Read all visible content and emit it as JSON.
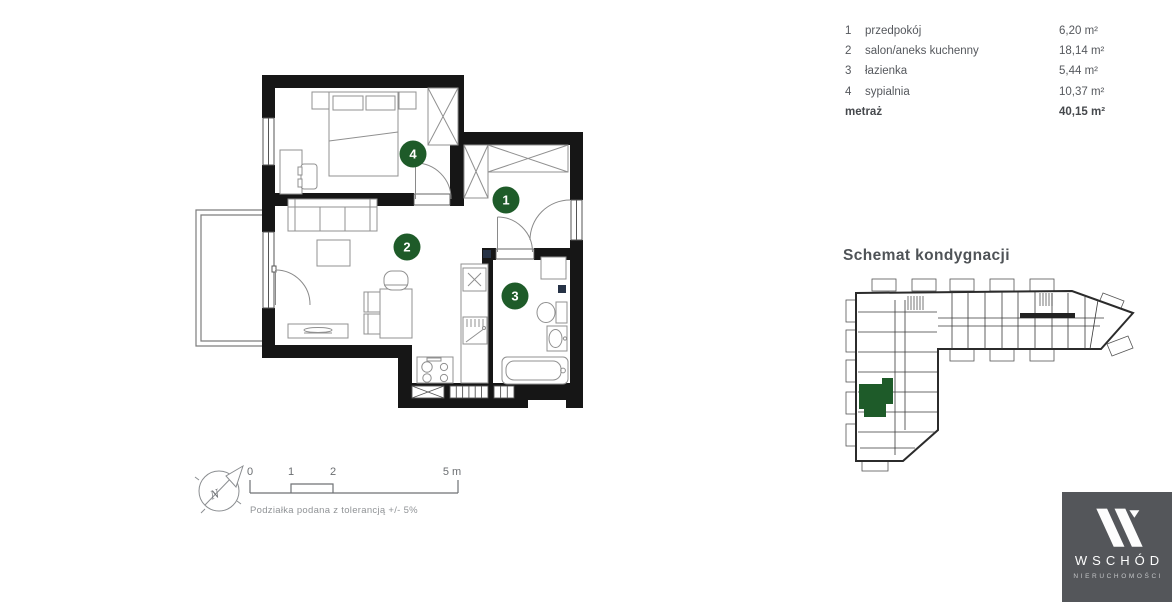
{
  "colors": {
    "brand_green": "#1e5b29",
    "wall_black": "#161616",
    "logo_bg": "#54565a"
  },
  "legend": {
    "rows": [
      {
        "num": "1",
        "label": "przedpokój",
        "area": "6,20 m²"
      },
      {
        "num": "2",
        "label": "salon/aneks kuchenny",
        "area": "18,14 m²"
      },
      {
        "num": "3",
        "label": "łazienka",
        "area": "5,44 m²"
      },
      {
        "num": "4",
        "label": "sypialnia",
        "area": "10,37 m²"
      }
    ],
    "total_label": "metraż",
    "total_area": "40,15 m²"
  },
  "plan": {
    "room_markers": [
      {
        "num": "1"
      },
      {
        "num": "2"
      },
      {
        "num": "3"
      },
      {
        "num": "4"
      }
    ]
  },
  "schematic": {
    "title": "Schemat kondygnacji"
  },
  "scalebar": {
    "tick0": "0",
    "tick1": "1",
    "tick2": "2",
    "tick5": "5 m",
    "note": "Podziałka podana z tolerancją +/- 5%"
  },
  "compass": {
    "north": "N"
  },
  "logo": {
    "brand": "WSCHÓD",
    "subtitle": "NIERUCHOMOŚCI"
  }
}
